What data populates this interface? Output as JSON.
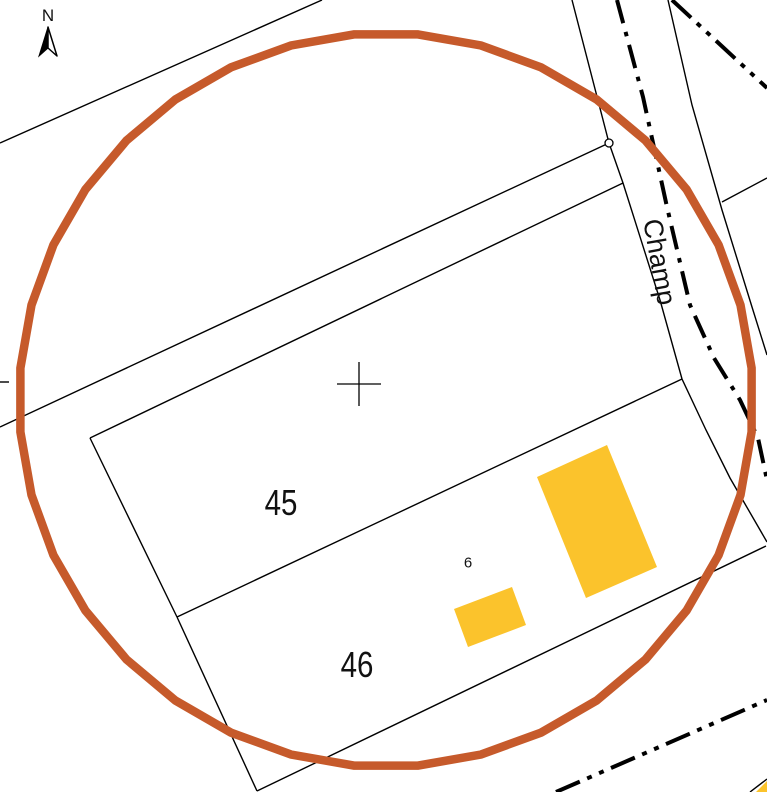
{
  "labels": {
    "north": "N",
    "parcel_45": "45",
    "parcel_46": "46",
    "building_6": "6",
    "street_name": "Champ"
  },
  "colors": {
    "background": "#ffffff",
    "line": "#000000",
    "building_fill": "#FBC32C",
    "circle_stroke": "#C65A2B"
  },
  "map_data": {
    "canvas": {
      "width": 767,
      "height": 792
    },
    "selection_circle": {
      "cx": 386,
      "cy": 400,
      "r": 367,
      "segments": 36,
      "stroke_width": 8.5
    },
    "survey_cross": {
      "cx": 359,
      "cy": 384,
      "arm": 22
    },
    "boundary_marker": {
      "cx": 609,
      "cy": 143,
      "r": 4
    },
    "thin_lines": [
      {
        "name": "field-boundary-topleft",
        "points": [
          [
            0,
            143
          ],
          [
            322,
            0
          ]
        ]
      },
      {
        "name": "strip-boundary-to-marker",
        "points": [
          [
            0,
            427
          ],
          [
            609,
            143
          ]
        ]
      },
      {
        "name": "left-edge-tick",
        "points": [
          [
            0,
            382
          ],
          [
            9,
            382
          ]
        ]
      },
      {
        "name": "parcel45-north-edge",
        "points": [
          [
            90,
            438
          ],
          [
            623,
            183
          ]
        ]
      },
      {
        "name": "parcel45-west-edge",
        "points": [
          [
            90,
            438
          ],
          [
            177,
            617
          ]
        ]
      },
      {
        "name": "parcel45-46-divider",
        "points": [
          [
            177,
            617
          ],
          [
            682,
            379
          ]
        ]
      },
      {
        "name": "parcel46-west-edge",
        "points": [
          [
            177,
            617
          ],
          [
            257,
            791
          ]
        ]
      },
      {
        "name": "parcel46-south-edge",
        "points": [
          [
            257,
            791
          ],
          [
            766,
            546
          ]
        ]
      },
      {
        "name": "road-west-edge",
        "points": [
          [
            572,
            0
          ],
          [
            609,
            143
          ],
          [
            623,
            183
          ],
          [
            660,
            300
          ],
          [
            682,
            379
          ],
          [
            706,
            430
          ],
          [
            730,
            478
          ],
          [
            767,
            542
          ]
        ]
      },
      {
        "name": "road-east-edge",
        "points": [
          [
            668,
            0
          ],
          [
            692,
            105
          ],
          [
            722,
            210
          ],
          [
            752,
            307
          ],
          [
            767,
            355
          ]
        ]
      },
      {
        "name": "east-boundary-stub",
        "points": [
          [
            767,
            178
          ],
          [
            722,
            202
          ]
        ]
      },
      {
        "name": "corner-building-edge",
        "points": [
          [
            750,
            792
          ],
          [
            767,
            779
          ]
        ]
      }
    ],
    "axis_lines": [
      {
        "name": "road-axis-champ",
        "points": [
          [
            617,
            0
          ],
          [
            643,
            97
          ],
          [
            667,
            207
          ],
          [
            690,
            305
          ],
          [
            714,
            358
          ],
          [
            740,
            400
          ],
          [
            758,
            438
          ],
          [
            767,
            480
          ]
        ],
        "dash": "24 9 4.5 9"
      },
      {
        "name": "road-axis-topright",
        "points": [
          [
            672,
            0
          ],
          [
            767,
            88
          ]
        ],
        "dash": "26 8 5 8 5 8"
      },
      {
        "name": "road-axis-bottomright",
        "points": [
          [
            556,
            792
          ],
          [
            767,
            700
          ]
        ],
        "dash": "26 8 5 8 5 8"
      }
    ],
    "buildings": [
      {
        "name": "building-large",
        "points": [
          [
            537,
            477
          ],
          [
            607,
            445
          ],
          [
            657,
            567
          ],
          [
            586,
            598
          ]
        ]
      },
      {
        "name": "building-small",
        "points": [
          [
            454,
            609
          ],
          [
            512,
            587
          ],
          [
            526,
            625
          ],
          [
            468,
            647
          ]
        ]
      },
      {
        "name": "building-corner-sliver",
        "points": [
          [
            756,
            792
          ],
          [
            767,
            781
          ],
          [
            767,
            792
          ]
        ]
      }
    ]
  }
}
